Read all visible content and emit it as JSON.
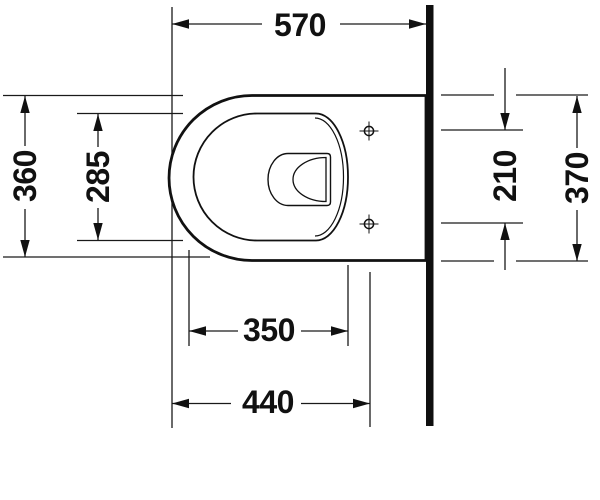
{
  "drawing": {
    "colors": {
      "line": "#1a1a1a",
      "object_outline": "#111111",
      "wall_fill": "#0f0f0f",
      "background": "#ffffff"
    },
    "symbols": {
      "fixing_hole": "crosshair-target-icon"
    },
    "dims": {
      "top_width": "570",
      "left_outer": "360",
      "left_inner": "285",
      "right_holes": "210",
      "right_outer": "370",
      "bottom_inner": "350",
      "bottom_outer": "440"
    }
  }
}
